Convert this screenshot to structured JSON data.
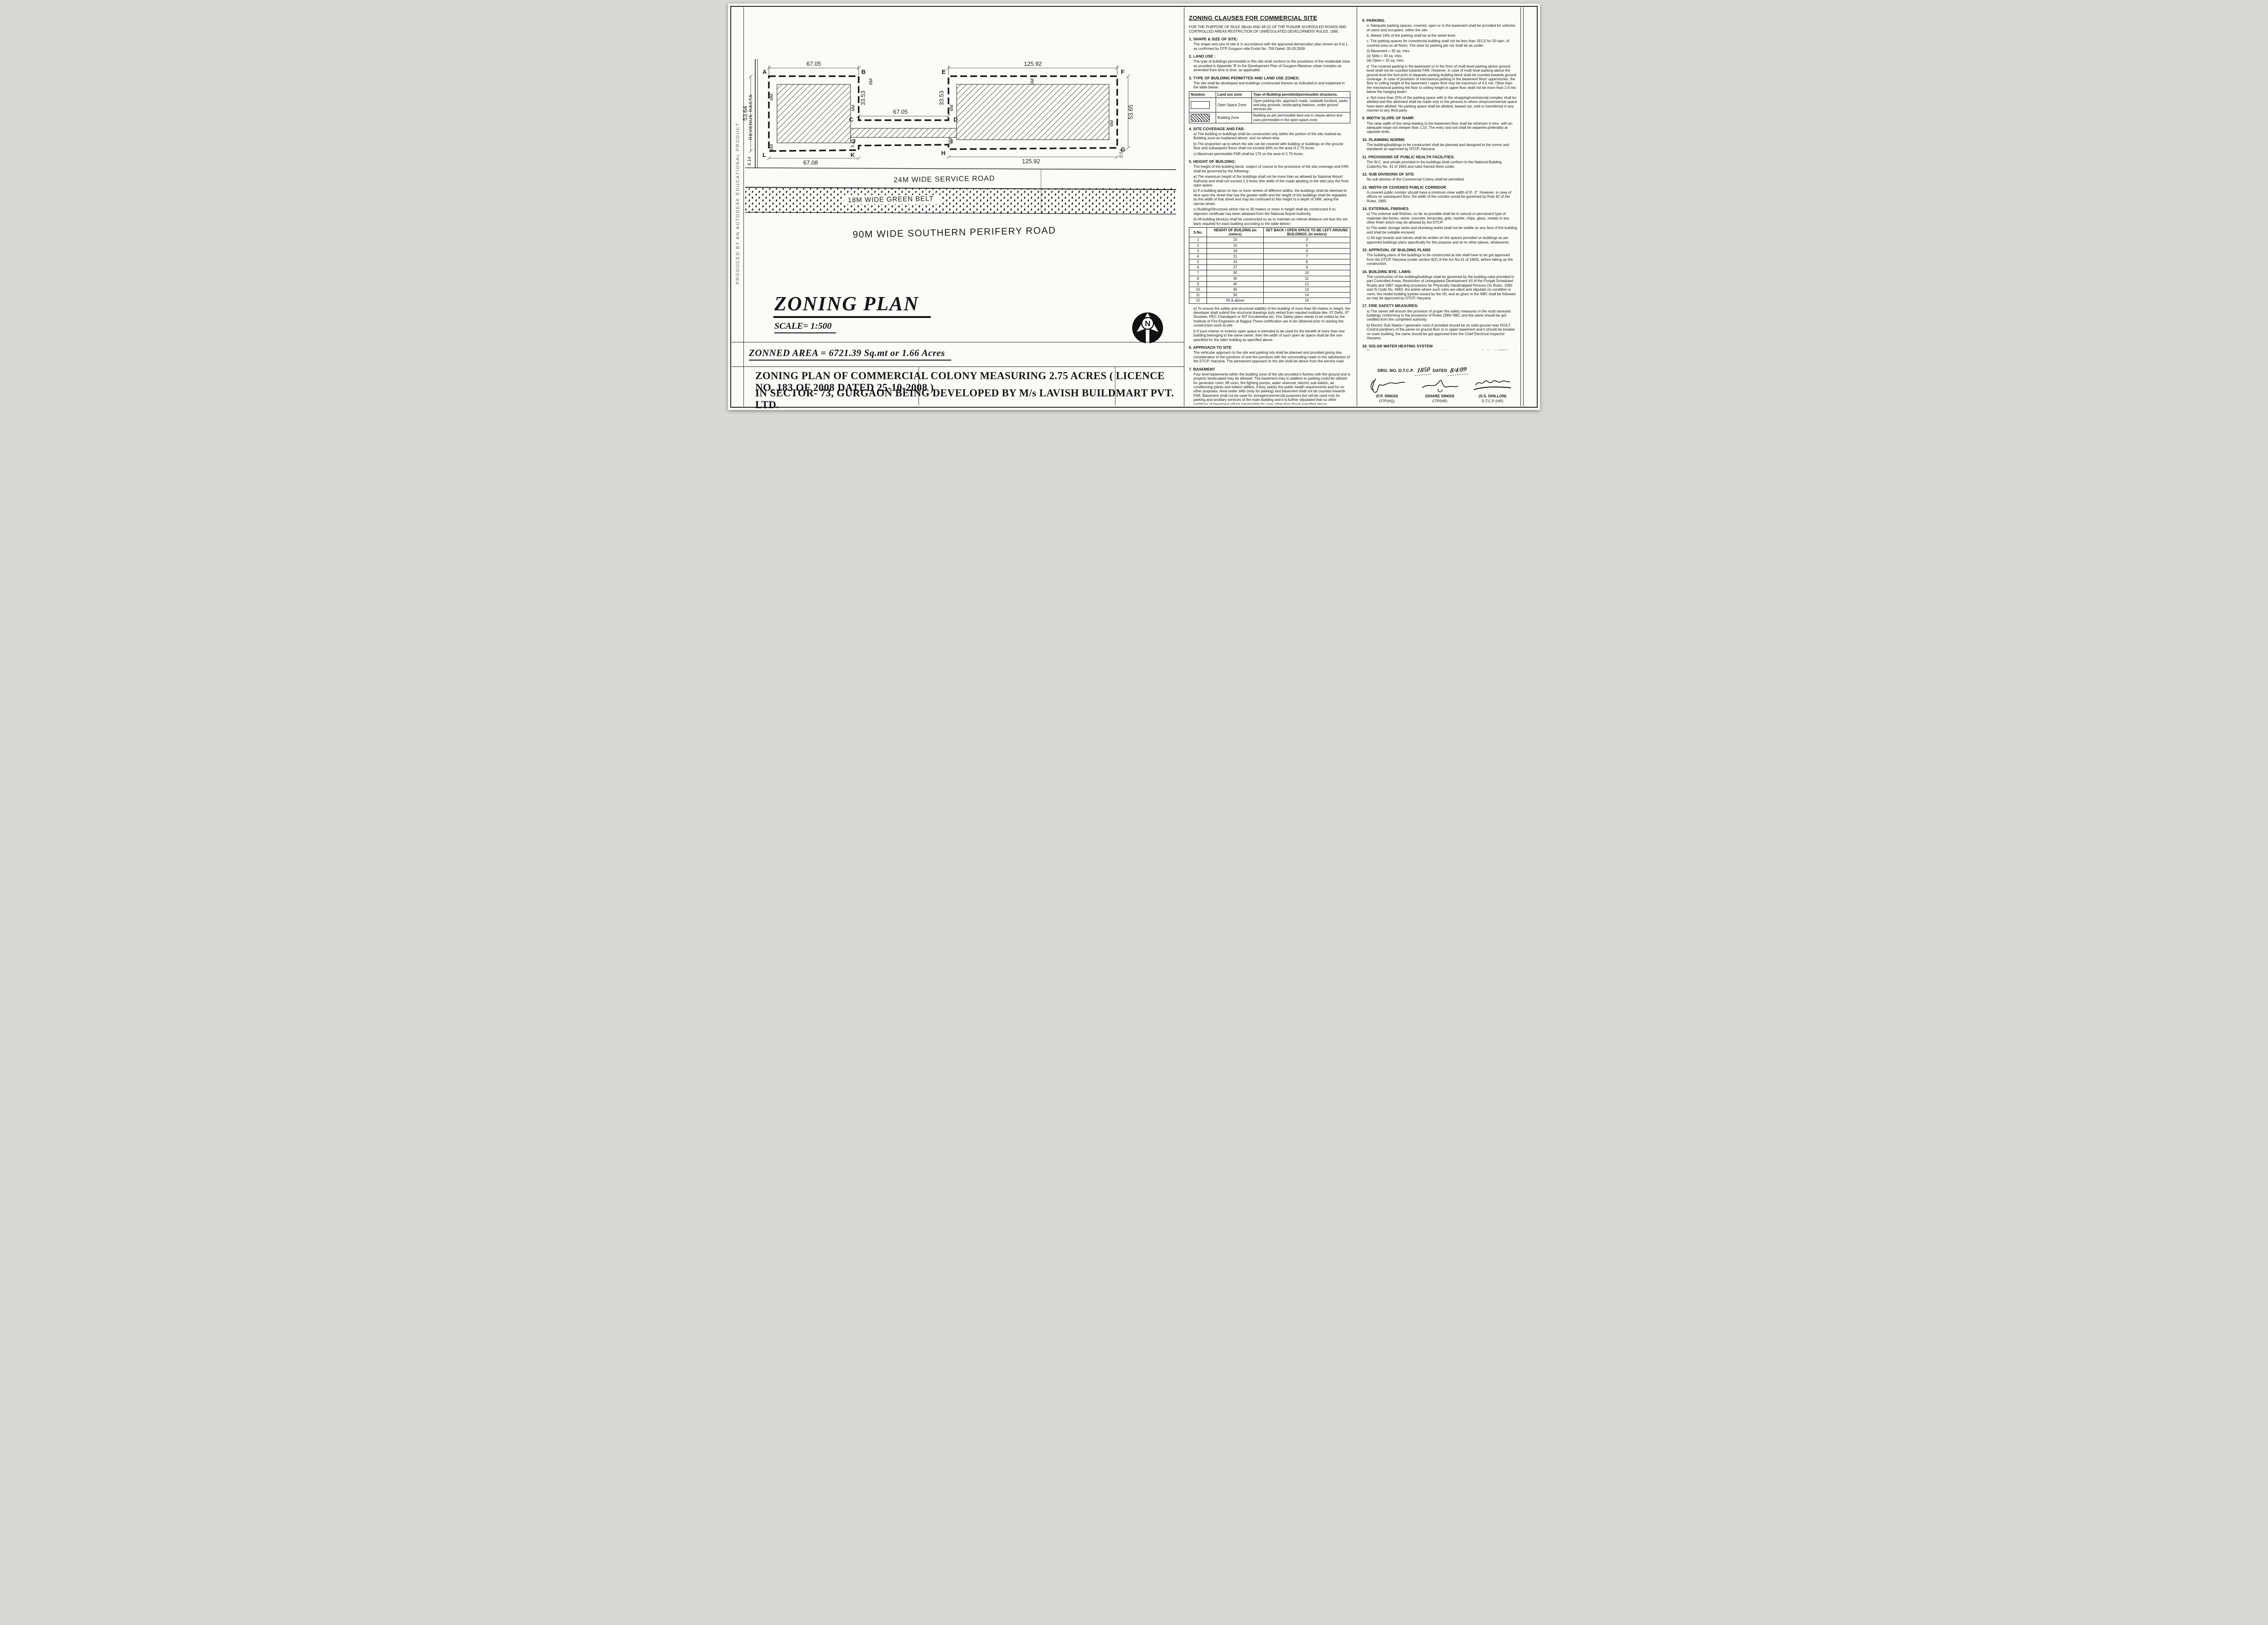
{
  "watermark": "PRODUCED BY AN AUTODESK EDUCATIONAL PRODUCT",
  "plan": {
    "pts": {
      "a": "A",
      "b": "B",
      "c": "C",
      "d": "D",
      "e": "E",
      "f": "F",
      "g": "G",
      "h": "H",
      "i": "I",
      "j": "J",
      "k": "K",
      "l": "L"
    },
    "dims": {
      "ab": "67.05",
      "cd": "67.05",
      "ef": "125.92",
      "lk": "67.08",
      "hg": "125.92",
      "left": "53.64",
      "right": "53.65",
      "bc": "33.53",
      "ed": "33.53",
      "jog": "3.35",
      "bl": "6.14",
      "br": "0.54"
    },
    "setback_label": "6M",
    "revenue_rasta": "REVENUE RASTA",
    "roads": {
      "service": "24M WIDE SERVICE ROAD",
      "green_belt": "18M WIDE GREEN BELT",
      "perifery": "90M WIDE SOUTHERN PERIFERY ROAD"
    },
    "compass_n": "N"
  },
  "title_block": {
    "title": "ZONING PLAN",
    "scale": "SCALE= 1:500",
    "zoned_area": "ZONNED AREA = 6721.39 Sq.mt or 1.66 Acres",
    "description_line1": "ZONING PLAN OF COMMERCIAL COLONY MEASURING 2.75 ACRES ( LICENCE NO. 183 OF 2008 DATED 25-10-2008 )",
    "description_line2": "IN SECTOR- 73, GURGAON BEING DEVELOPED BY M/s LAVISH BUILDMART PVT. LTD."
  },
  "mid": {
    "heading": "ZONING CLAUSES FOR COMMERCIAL SITE",
    "intro": "FOR THE PURPOSE OF RULE 38(xiii) AND 48 (2) OF THE PUNJAB SCHEDULED ROADS AND CONTROLLED AREAS RESTRICTION OF UNREGULATED DEVELOPMENT RULES, 1965.",
    "s1_title": "1.  SHAPE & SIZE OF SITE:",
    "s1_body": "The shape and size of site is in accordance with the approved demarcation plan shown as A to L. as confirmed by DTP Gurgaon vide Endst No .759  Dated .05.03.2009",
    "s2_title": "2.  LAND USE    :",
    "s2_body": "The type of buildings permissible in this site shall conform to the provisions of the residential zone as provided in Appendix 'B' to the Development Plan of Gurgaon Manesar urban complex as amended from time to time, as applicable.",
    "s3_title": "3.  TYPE OF BUILDING PERMITTED AND LAND USE  ZONES:",
    "s3_body": "The site shall be developed and buildings constructed thereon as indicated in and explained in the table below:",
    "land_table": {
      "h_notation": "Notation",
      "h_zone": "Land use zone",
      "h_type": "Type of Building permitted/permissible structures.",
      "r1_zone": "Open Space Zone",
      "r1_type": "Open parking lots, approach roads, roadside furniture, parks and play grounds, landscaping features, under ground services etc.",
      "r2_zone": "Building Zone",
      "r2_type": "Building as per permissible land use in clause   above and uses permissible in the open space zone."
    },
    "s4_title": "4.  SITE COVERAGE AND FAR:",
    "s4_a": "a)  The building or buildings shall be constructed only within the portion of the site marked as Building zone as explained above, and no where else.",
    "s4_b": "b)  The proportion up to which the site can be covered with building or buildings on the ground floor and subsequent floors shall not exceed 40% on the area of 2.75 Acres",
    "s4_c": "c)  Maximum permissible FAR shall be 175 on the area of 2.75 Acres.",
    "s5_title": "5.  HEIGHT OF BUILDING:",
    "s5_intro": "The height of the building block, subject of course to the provisions of the site coverage and FAR, shall be governed by the following:-",
    "s5_a": "a)  The maximum height of the buildings shall not be more than as allowed by National Airport Authority and shall not  exceed 1.5 times (the width of the roads abutting to the site) plus  the front open space.",
    "s5_b": "b)  If a building abuts on two or more streets of different widths, the buildings shall be  deemed to face upon the street that has the greater width and the height of the buildings  shall be regulated by the width of that street and may be continued to this height to a depth of 24M, along the narrow street.",
    "s5_c": "c)  Building/Structures which rise to 30 meters or more in height shall be constructed if no objection certificate has been obtained from the National Airport Authority.",
    "s5_d": "d)  All building block(s) shall be constructed so as to maintain an interse distance not less the set back required for each building according to the table below:-",
    "height_table": {
      "h_sno": "S.No.",
      "h_height": "HEIGHT OF BUILDING (in meters)",
      "h_setback": "SET BACK / OPEN SPACE TO BE LEFT AROUND BUILDINGS. (in meters)",
      "rows": [
        [
          "1",
          "10",
          "3"
        ],
        [
          "2",
          "15",
          "5"
        ],
        [
          "3",
          "18",
          "6"
        ],
        [
          "4",
          "21",
          "7"
        ],
        [
          "5",
          "24",
          "8"
        ],
        [
          "6",
          "27",
          "9"
        ],
        [
          "7",
          "30",
          "10"
        ],
        [
          "8",
          "35",
          "11"
        ],
        [
          "9",
          "40",
          "12"
        ],
        [
          "10",
          "45",
          "13"
        ],
        [
          "11",
          "50",
          "14"
        ],
        [
          "12",
          "55 & above",
          "16"
        ]
      ]
    },
    "s5_e": "e)  To ensure fire safety and structural stability of the building of more than 60 meters in height,  the developer shall submit the structural drawings duly vetted from reputed institute like-  IIT Delhi, IIT Roorkee, PEC Chandigarh or NIT Kurukshetra etc. Fire Safety plans needs to be  vetted by the Institute of Fire Engineers at Nagpur.These certification are to be obtained prior  to starting the construction work at site.",
    "s5_f": "f)  If such interior or exterior open space is intended to be used for the benefit of more  than  one building belonging to the same owner, then the width of such open air space  shall be the  one specified for the taller building as specified above.",
    "s6_title": "6.  APPROACH TO SITE",
    "s6_body": "The vehicular approach to the site and parking lots shall be planned and provided giving due  consideration to the junctions of and the junctions with the surrounding roads to the satisfaction of the DTCP, Haryana.  The permanent approach to the site shall be derive from the service road.",
    "s7_title": "7.  BASEMENT",
    "s7_body": "Four level basements within the building zone of the site provided it flushes with the  ground and is properly landscaped may be allowed.  The basement may in addition to  parking could be utilized for generator room, lift room, fire fighting pumps, water  reservoir, electric sub-station, air conditioning plants and toilets/ utilities, if they satisfy the  public health requirements and for no other purposes. Area under stilts (only for parking) and basement  shall not be counted towards FAR.   Basement shall not be used for  storage/commercial purposes but will be used only for parking and ancillary services of the main building and  it is further stipulated that no other partitions of basement will be permissible for uses other than those specified above."
  },
  "right": {
    "s9p_title": "9.  PARKING.",
    "s9p_a": "a.  Adequate parking spaces, covered, open or in the basement shall be provided for vehicles of users  and occupiers, within the site.",
    "s9p_b": "b.  Atleast 15% of the parking shall be at the street level.",
    "s9p_c": "c.  The parking spaces for commercial building shall not be less than 1ECS for 50 sqm. of covered area on all floors. The area for parking per car shall be as under:",
    "s9p_i": "(i)  Basement   =   35 sq. mtrs.",
    "s9p_ii": "(ii)  Stilts        =   30 sq. mtrs.",
    "s9p_iii": "(iii) Open       =   25 sq. mtrs.",
    "s9p_d": "d.  The covered parking in the basement or in the form of multi level parking above ground level shall not be counted towards FAR. However, in case of multi level parking above the ground level the foot print of separate parking building block shall be counted towards ground coverage. In case of provision of mechanical parking in the basement floor/ upperstories, the floor to ceiling height of the basement / upper floor  may be maximum of 4.5 mtr. Other than the mechanical parking the floor to ceiling height in upper floor shall not be more than 2.4 mtr. below the hanging beam.",
    "s9p_e": "e.  Not more than 25% of the parking space with in the shopping/commercial complex shall be allotted and this allotment shall be made only to the persons to whom shop/commercial space have been allotted. No parking space shall be allotted, leased out, sold or transferred in any manner to any  third party.",
    "s9r_title": "9.  WIDTH/ SLOPE OF RAMP.",
    "s9r_body": "The clear width of the ramp leading to the basement floor shall be minimum 4 mtrs. with an adequate slope not steeper than 1:10. The entry and exit shall be separete preferably at opposite ends.",
    "s10_title": "10. PLANNING NORMS",
    "s10_body": "The building/buildings to be constructed shall be planned and designed to the norms and standards as approved by DTCP, Haryana.",
    "s11_title": "11. PROVISIONS OF PUBLIC HEALTH FACILITIES.",
    "s11_body": "The W.C. and urinals provided in the buildings shall conform to the National Building Code/Act No. 41  of 1963 and rules framed there under.",
    "s12_title": "12. SUB DIVISIONS OF SITE",
    "s12_body": "No sub division of the Commercial Colony shall be permitted.",
    "s13_title": "13. WIDTH OF COVERED PUBLIC CORRIDOR",
    "s13_body": "A covered public corridor should have a minimum clear width of 8'- 3\".  However, in case of offices on subsequent floor, the width of the corridor would be governed by Rule 82 of the Rules, 1965.",
    "s14_title": "14. EXTERNAL FINISHES",
    "s14_a": "a)  The external wall finishes, so far as possible shall be in natural or permanent type of materials like  bricks, stone, concrete, terracotta, grits, marble,  chips, glass, metals or any other finish which may  be allowed by the DTCP.",
    "s14_b": "b)  The water storage tanks and plumbing works shall not be visible on any face of the building and  shall be suitable encased.",
    "s14_c": "c)  All sign boards and names shall be written on the spaces provided on buildings as per approved buildings plans specifically for this purpose and at no other places, whatsoever.",
    "s15_title": "15. APPROVAL OF BUILDING PLANS",
    "s15_body": "The building plans of the buildings to be constructed at site shall have to be got approved from the DTCP,  Haryana (under section 8(2) of the Act No.41 of 1963), before taking up the construction.",
    "s16_title": "16. BUILDING BYE- LAWS:",
    "s16_body": "The construction of the building/buildings shall be governed by the building rules provided in part  Controlled Areas, Restriction of Unregulated Development  VII of the Punjab Scheduled Roads and   1987 regarding provisions for Physically Handicapped Persons.On  Rules, 1965 and IS Code No. 4963- the points where such rules are silent and stipulate no condition or norm, the model building byelaw issued by the ISI, and as given in the NBC shall be followed as may be approved by DTCP, Haryana.",
    "s17_title": "17. FIRE SAFETY MEASURES:",
    "s17_a": "a)  The owner will ensure the provision of proper fire safety measures in the multi storeyed buildings conforming to the provisions of  Rules 1965/ NBC and the same should be got certified from the  competent authority.",
    "s17_b": "b)  Electric Sub Station / generator room if provided should be on solid ground near DG/LT. Control  periphery of the  panel on ground floor or in upper basement and it should be located on outer building, the same should be got approved from the Chief Electrical inspector Haryana.",
    "s18_title": "18. SOLAR WATER HEATING SYSTEM",
    "s18_body": "The provision of solar water heating system shall be as per norms specified by HAREDA  and shall be made operational in each building block (if hot water is required) before applying for an occupation certificate.",
    "s19_title": "19. RAIN WATER HARVESTING SYSTEM",
    "s19_body": "The rain water harvesting system shall be provided as per Central Ground Water Authority norms/Haryana Govt. notification as applicable.",
    "s20": "20  The coloniser shall obtain the clearance/NOC as per the provisions of the Notification  No. S.O. 1533 (E) Dated 14.9.2006 issued by Ministry of Environment and Forest,  Government of India before starting the construction/ execution of development  works at site.",
    "s21": "21. The coloniser/owner shall use only Compact Fluorescent Lamps fittings for internal lighting as  well as campus lighting.",
    "s22": "22. The coloniser shall convey the ultimate power load requirement of the project to the concerned power utility to enable the provision of project to the concerned site for transformer/switchingstation /electric  sub station as per the norms prescribed by the power utility in the project site before submission of Building plan not later then 2 months from the approval of zoning plan.",
    "drg_prefix": "DRG. NO. D.T.C.P.",
    "drg_no": "1850",
    "drg_dated": "DATED",
    "drg_date": "8/4/09",
    "signatures": [
      {
        "name": "(F.P. SINGH)",
        "role": "DTP(HQ)"
      },
      {
        "name": "(DHARE SINGH)",
        "role": "CTP(HR)"
      },
      {
        "name": "(S.S. DHILLON)",
        "role": "D.T.C.P (HR)"
      }
    ]
  }
}
